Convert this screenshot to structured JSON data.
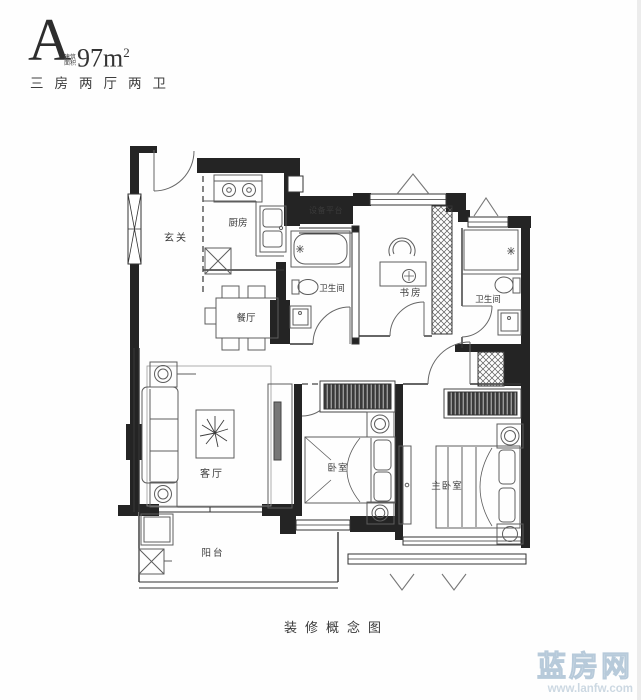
{
  "header": {
    "type_label": "A",
    "area_prefix": "建筑面积",
    "area_value": "97m",
    "area_sup": "2",
    "layout_text": "三房两厅两卫"
  },
  "plan": {
    "rooms": {
      "entry": "玄关",
      "kitchen": "厨房",
      "dining": "餐厅",
      "equipment": "设备平台",
      "bath1": "卫生间",
      "study": "书房",
      "bath2": "卫生间",
      "living": "客厅",
      "bedroom": "卧室",
      "master": "主卧室",
      "balcony": "阳台"
    }
  },
  "caption": "装修概念图",
  "watermark": {
    "brand": "蓝房网",
    "url": "www.lanfw.com"
  },
  "colors": {
    "wall": "#242424",
    "line": "#5d5d5d",
    "text": "#3a3a3a",
    "watermark": "#c3d2de"
  }
}
